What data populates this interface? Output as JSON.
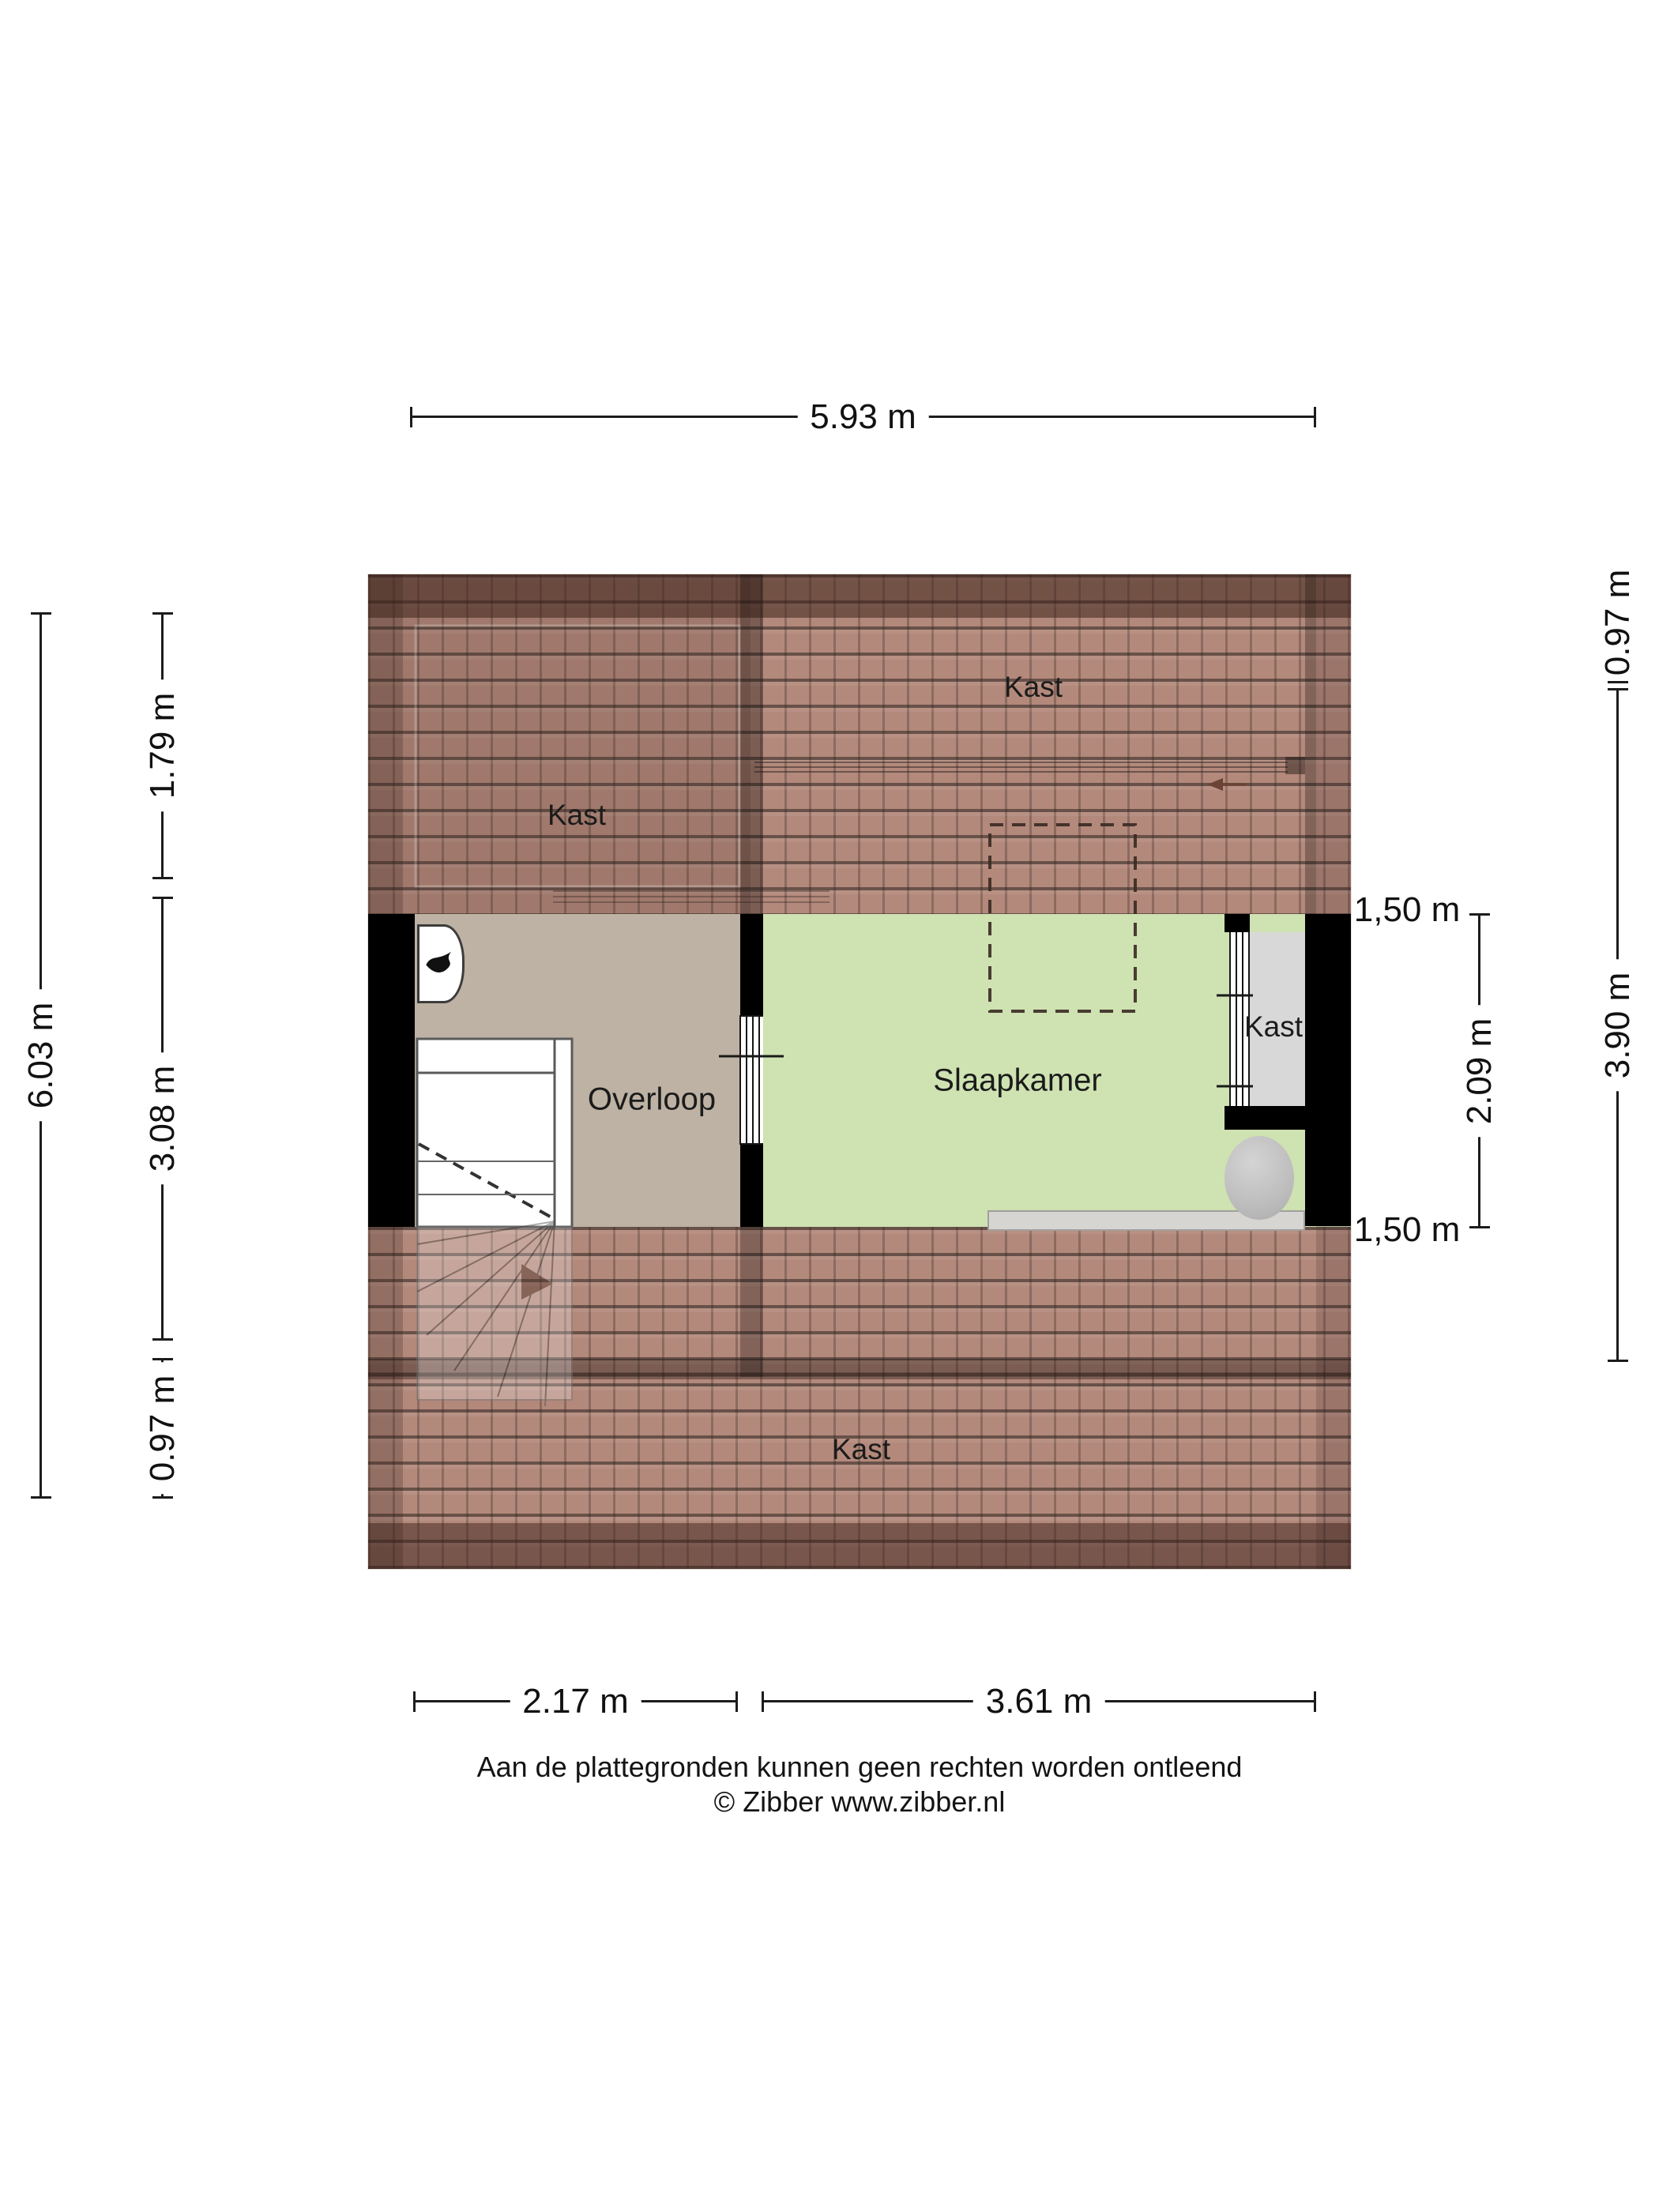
{
  "title": "Attic floor plan",
  "labels": {
    "kast_top_left": "Kast",
    "kast_top_right": "Kast",
    "kast_closet": "Kast",
    "kast_bottom": "Kast",
    "overloop": "Overloop",
    "slaapkamer": "Slaapkamer"
  },
  "dimensions": {
    "top_width": "5.93 m",
    "left_total": "6.03 m",
    "left_upper": "1.79 m",
    "left_middle": "3.08 m",
    "left_lower": "0.97 m",
    "right_upper": "0.97 m",
    "right_total": "3.90 m",
    "right_room": "2.09 m",
    "height_marker_top": "1,50 m",
    "height_marker_bottom": "1,50 m",
    "bottom_left": "2.17 m",
    "bottom_right": "3.61 m"
  },
  "footer": {
    "disclaimer": "Aan de plattegronden kunnen geen rechten worden ontleend",
    "copyright": "© Zibber www.zibber.nl"
  },
  "colors": {
    "roof_base": "#b3897b",
    "roof_ridge_dark": "#5d3f35",
    "floor_overloop": "#bdb2a3",
    "floor_slaapkamer": "#cfe2b2",
    "wall": "#000000",
    "closet_fill": "#d8d8d8",
    "dimension_text": "#111111"
  }
}
